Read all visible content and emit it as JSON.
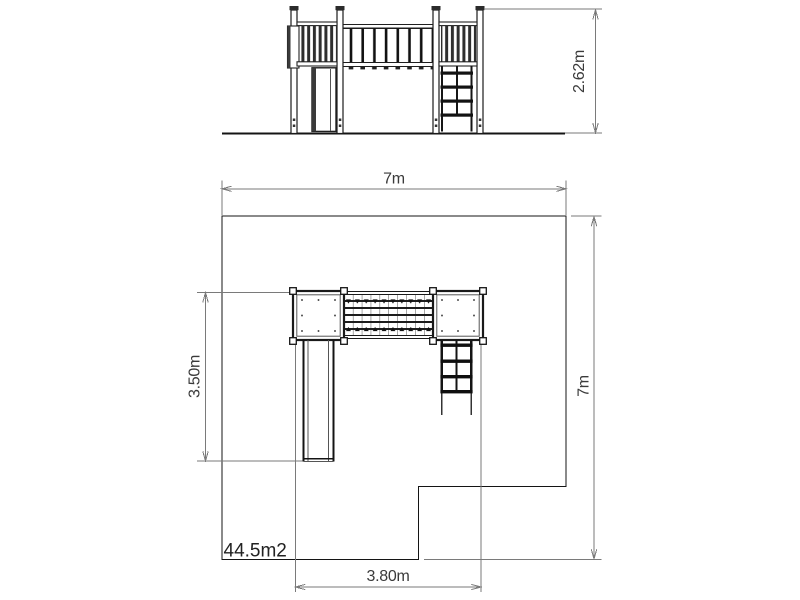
{
  "drawing": {
    "subject": "playground-structure-technical-drawing",
    "views": {
      "top": "front-elevation",
      "bottom": "plan-view"
    }
  },
  "dims": {
    "elevation_height": "2.62m",
    "plan_width": "7m",
    "plan_depth": "7m",
    "structure_depth": "3.50m",
    "structure_width": "3.80m",
    "area": "44.5m2"
  },
  "colors": {
    "structure_line": "#141414",
    "dimension_line": "#7a7a7a",
    "dimension_text": "#3a3a3a",
    "background": "#ffffff"
  }
}
